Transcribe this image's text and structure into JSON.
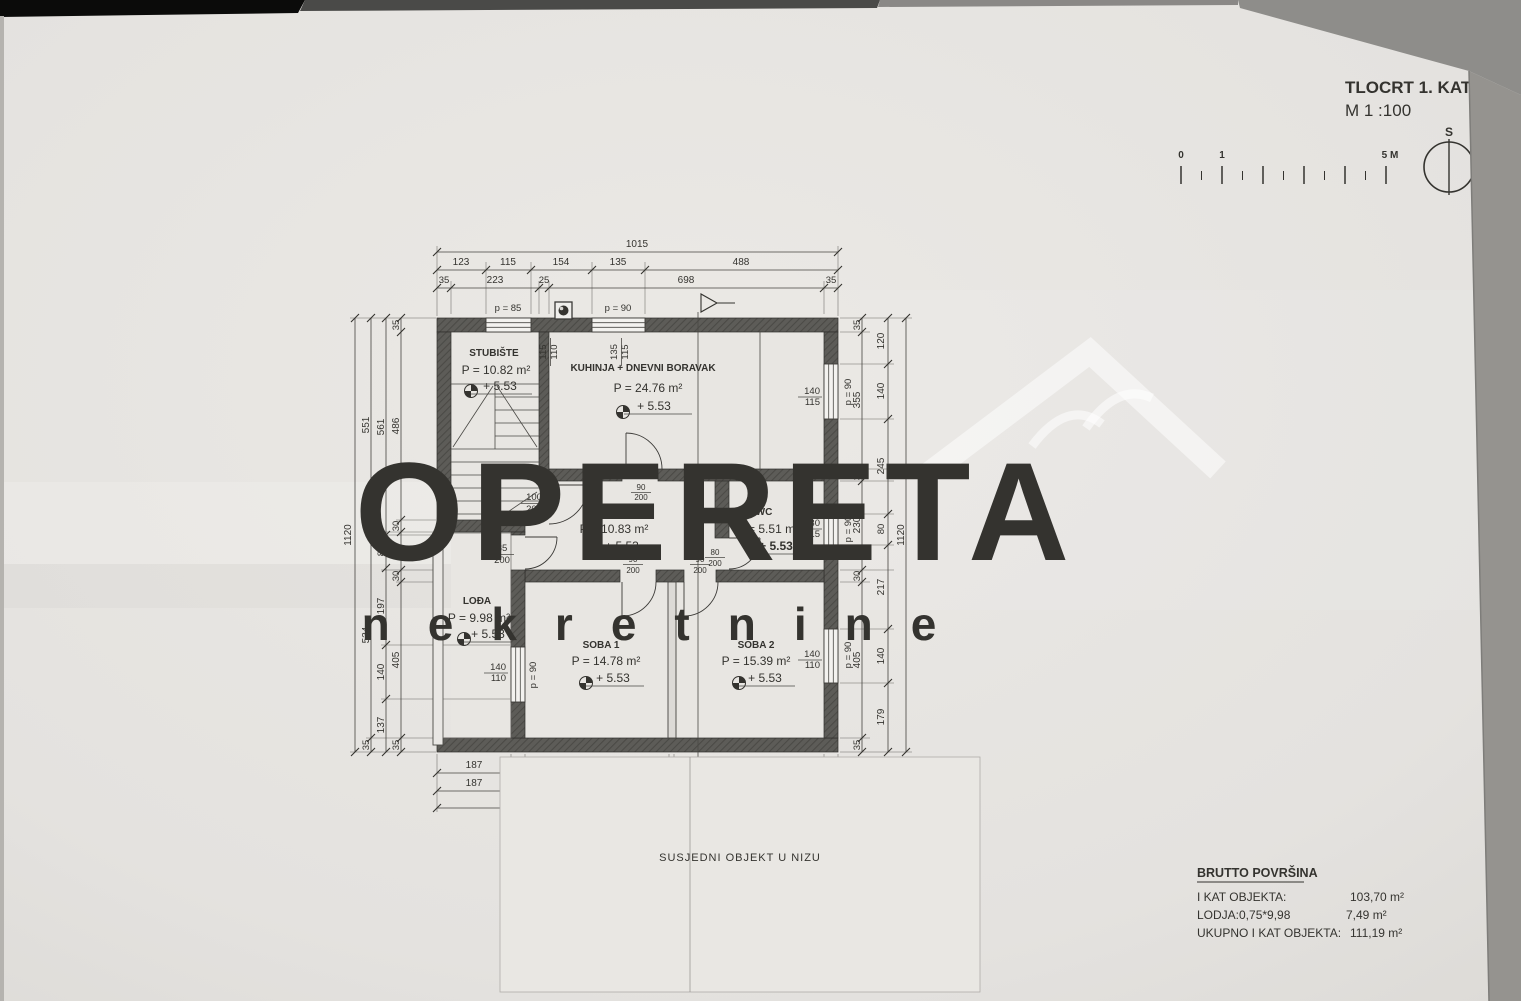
{
  "header": {
    "title": "TLOCRT 1. KATA",
    "scale": "M 1 :100"
  },
  "compass": {
    "label": "S"
  },
  "scalebar": {
    "zero": "0",
    "one": "1",
    "five": "5 M"
  },
  "watermark": {
    "brand": "OPERETA",
    "sub": "nekretnine"
  },
  "rooms": [
    {
      "name": "STUBIŠTE",
      "area": "P = 10.82 m²",
      "elev": "+ 5.53"
    },
    {
      "name": "KUHINJA + DNEVNI BORAVAK",
      "area": "P = 24.76 m²",
      "elev": "+ 5.53"
    },
    {
      "name": "HODNIK",
      "area": "P = 10.83 m²",
      "elev": "+ 5.53"
    },
    {
      "name": "WC",
      "area": "P = 5.51 m²",
      "elev": "+ 5.53"
    },
    {
      "name": "LOĐA",
      "area": "P = 9.98 m²",
      "elev": "+ 5.53"
    },
    {
      "name": "SOBA 1",
      "area": "P = 14.78 m²",
      "elev": "+ 5.53"
    },
    {
      "name": "SOBA 2",
      "area": "P = 15.39 m²",
      "elev": "+ 5.53"
    }
  ],
  "windows": [
    {
      "w": "115",
      "h": "110",
      "p": "p = 85"
    },
    {
      "w": "135",
      "h": "115",
      "p": "p = 90"
    },
    {
      "w": "140",
      "h": "115",
      "p": "p = 90"
    },
    {
      "w": "80",
      "h": "115",
      "p": "p = 90"
    },
    {
      "w": "140",
      "h": "110",
      "p": "p = 90"
    },
    {
      "w": "140",
      "h": "110",
      "p": "p = 90"
    }
  ],
  "doors": [
    {
      "w": "100",
      "h": "200"
    },
    {
      "w": "85",
      "h": "200"
    },
    {
      "w": "90",
      "h": "200"
    },
    {
      "w": "90",
      "h": "200"
    },
    {
      "w": "90",
      "h": "200"
    },
    {
      "w": "80",
      "h": "200"
    }
  ],
  "dims": {
    "top": {
      "row1": [
        "1015"
      ],
      "row2": [
        "123",
        "115",
        "154",
        "135",
        "488"
      ],
      "row3": [
        "35",
        "223",
        "25",
        "698",
        "35"
      ]
    },
    "bottom": {
      "row1": [
        "187",
        "35",
        "365",
        "13",
        "380",
        "35"
      ],
      "row2": [
        "187",
        "828"
      ],
      "row3": [
        "1015"
      ]
    },
    "left": {
      "c1": [
        "1120"
      ],
      "c2": [
        "551",
        "534",
        "35"
      ],
      "c3": [
        "561",
        "85",
        "197",
        "140",
        "137"
      ],
      "c4": [
        "35",
        "486",
        "30",
        "99",
        "30",
        "405",
        "35"
      ]
    },
    "right": {
      "c1": [
        "35",
        "355",
        "30",
        "230",
        "30",
        "405",
        "35"
      ],
      "c2": [
        "120",
        "140",
        "245",
        "80",
        "217",
        "140",
        "179"
      ],
      "c3": [
        "1120"
      ]
    }
  },
  "neighbor_label": "SUSJEDNI OBJEKT U NIZU",
  "summary": {
    "title": "BRUTTO POVRŠINA",
    "rows": [
      {
        "label": "I KAT OBJEKTA:",
        "value": "103,70 m²"
      },
      {
        "label": "LODJA:0,75*9,98",
        "value": "7,49 m²"
      },
      {
        "label": "UKUPNO I KAT OBJEKTA:",
        "value": "111,19 m²"
      }
    ]
  },
  "colors": {
    "paper": "#e6e4e1",
    "ink": "#34332f",
    "wall": "#5b5a56",
    "watermark": "rgba(255,255,255,0.5)"
  }
}
